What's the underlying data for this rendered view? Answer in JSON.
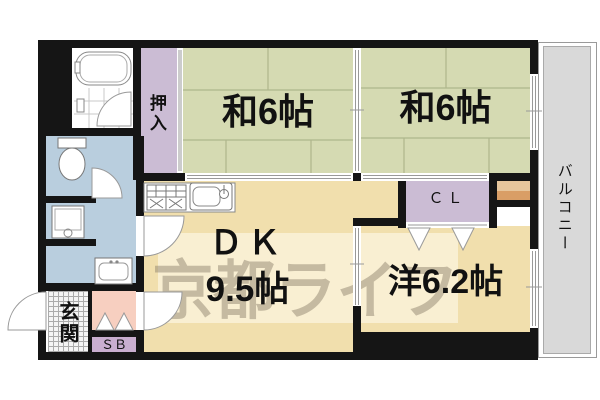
{
  "floorplan": {
    "balcony": {
      "label": "バルコニー"
    },
    "rooms": {
      "oshiire": {
        "label": "押入"
      },
      "washitsu1": {
        "label": "和6帖"
      },
      "washitsu2": {
        "label": "和6帖"
      },
      "dk": {
        "name_label": "ＤＫ",
        "size_label": "9.5帖"
      },
      "youshitsu": {
        "label": "洋6.2帖"
      },
      "closet": {
        "label": "ＣＬ"
      },
      "genkan": {
        "label": "玄関"
      },
      "shoe_box": {
        "label": "ＳＢ"
      }
    },
    "watermark": {
      "label": "京都ライフ"
    },
    "fixtures": {
      "bathtub": "bathtub-icon",
      "toilet": "toilet-icon",
      "washing_machine": "washing-machine-icon",
      "washbasin": "washbasin-icon",
      "stove": "stove-icon",
      "sink": "kitchen-sink-icon"
    },
    "colors": {
      "tatami_green": "#d5dab2",
      "tatami_line": "#aeb68c",
      "room_cream": "#f1dfad",
      "closet_purple": "#cbbcd4",
      "shoebox_purple": "#c9aed0",
      "sanitary_blue": "#b9cede",
      "hall_pink": "#f7cfc0",
      "balcony_gray": "#d9d9d9",
      "wall_black": "#151515",
      "step_light": "#e7c69c",
      "step_dark": "#d99e66",
      "watermark_gray": "#918779"
    }
  }
}
